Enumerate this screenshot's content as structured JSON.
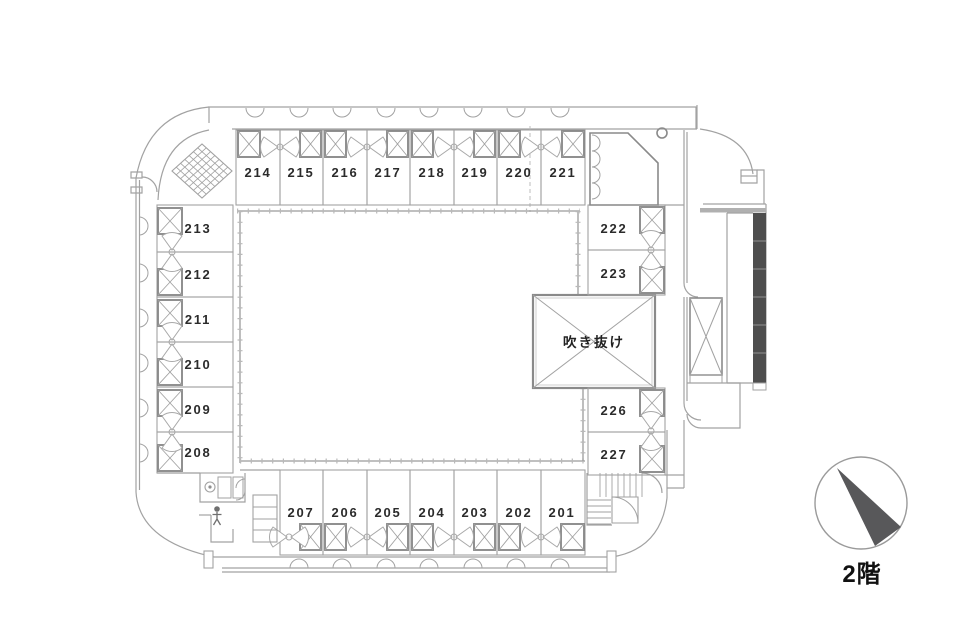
{
  "floor_label": "2階",
  "atrium": {
    "label": "吹き抜け",
    "x": 533,
    "y": 295,
    "w": 122,
    "h": 93
  },
  "colors": {
    "line": "#a2a2a2",
    "wall": "#8a8a8a",
    "text": "#2b2b2b",
    "hatch_dark": "#4e4e4e",
    "compass_arrow": "#58585a"
  },
  "rooms": [
    {
      "num": "214",
      "strip": "t",
      "x": 236,
      "y": 130,
      "w": 44,
      "h": 75,
      "bed": [
        238,
        131,
        22,
        26
      ],
      "lx": 258,
      "ly": 177
    },
    {
      "num": "215",
      "strip": "t",
      "x": 280,
      "y": 130,
      "w": 43,
      "h": 75,
      "bed": [
        300,
        131,
        21,
        26
      ],
      "lx": 301,
      "ly": 177
    },
    {
      "num": "216",
      "strip": "t",
      "x": 323,
      "y": 130,
      "w": 44,
      "h": 75,
      "bed": [
        325,
        131,
        21,
        26
      ],
      "lx": 345,
      "ly": 177
    },
    {
      "num": "217",
      "strip": "t",
      "x": 367,
      "y": 130,
      "w": 43,
      "h": 75,
      "bed": [
        387,
        131,
        21,
        26
      ],
      "lx": 388,
      "ly": 177
    },
    {
      "num": "218",
      "strip": "t",
      "x": 410,
      "y": 130,
      "w": 44,
      "h": 75,
      "bed": [
        412,
        131,
        21,
        26
      ],
      "lx": 432,
      "ly": 177
    },
    {
      "num": "219",
      "strip": "t",
      "x": 454,
      "y": 130,
      "w": 43,
      "h": 75,
      "bed": [
        474,
        131,
        21,
        26
      ],
      "lx": 475,
      "ly": 177
    },
    {
      "num": "220",
      "strip": "t",
      "x": 497,
      "y": 130,
      "w": 44,
      "h": 75,
      "bed": [
        499,
        131,
        21,
        26
      ],
      "lx": 519,
      "ly": 177
    },
    {
      "num": "221",
      "strip": "t",
      "x": 541,
      "y": 130,
      "w": 44,
      "h": 75,
      "bed": [
        562,
        131,
        22,
        26
      ],
      "lx": 563,
      "ly": 177
    },
    {
      "num": "213",
      "strip": "l",
      "x": 157,
      "y": 205,
      "w": 76,
      "h": 47,
      "bed": [
        158,
        208,
        24,
        26
      ],
      "lx": 198,
      "ly": 233
    },
    {
      "num": "212",
      "strip": "l",
      "x": 157,
      "y": 252,
      "w": 76,
      "h": 45,
      "bed": [
        158,
        269,
        24,
        26
      ],
      "lx": 198,
      "ly": 279
    },
    {
      "num": "211",
      "strip": "l",
      "x": 157,
      "y": 297,
      "w": 76,
      "h": 45,
      "bed": [
        158,
        300,
        24,
        26
      ],
      "lx": 198,
      "ly": 324
    },
    {
      "num": "210",
      "strip": "l",
      "x": 157,
      "y": 342,
      "w": 76,
      "h": 45,
      "bed": [
        158,
        359,
        24,
        26
      ],
      "lx": 198,
      "ly": 369
    },
    {
      "num": "209",
      "strip": "l",
      "x": 157,
      "y": 387,
      "w": 76,
      "h": 45,
      "bed": [
        158,
        390,
        24,
        26
      ],
      "lx": 198,
      "ly": 414
    },
    {
      "num": "208",
      "strip": "l",
      "x": 157,
      "y": 432,
      "w": 76,
      "h": 41,
      "bed": [
        158,
        445,
        24,
        26
      ],
      "lx": 198,
      "ly": 457
    },
    {
      "num": "207",
      "strip": "b",
      "x": 280,
      "y": 470,
      "w": 43,
      "h": 85,
      "bed": [
        300,
        524,
        21,
        26
      ],
      "lx": 301,
      "ly": 517
    },
    {
      "num": "206",
      "strip": "b",
      "x": 323,
      "y": 470,
      "w": 44,
      "h": 85,
      "bed": [
        325,
        524,
        21,
        26
      ],
      "lx": 345,
      "ly": 517
    },
    {
      "num": "205",
      "strip": "b",
      "x": 367,
      "y": 470,
      "w": 43,
      "h": 85,
      "bed": [
        387,
        524,
        21,
        26
      ],
      "lx": 388,
      "ly": 517
    },
    {
      "num": "204",
      "strip": "b",
      "x": 410,
      "y": 470,
      "w": 44,
      "h": 85,
      "bed": [
        412,
        524,
        21,
        26
      ],
      "lx": 432,
      "ly": 517
    },
    {
      "num": "203",
      "strip": "b",
      "x": 454,
      "y": 470,
      "w": 43,
      "h": 85,
      "bed": [
        474,
        524,
        21,
        26
      ],
      "lx": 475,
      "ly": 517
    },
    {
      "num": "202",
      "strip": "b",
      "x": 497,
      "y": 470,
      "w": 44,
      "h": 85,
      "bed": [
        499,
        524,
        21,
        26
      ],
      "lx": 519,
      "ly": 517
    },
    {
      "num": "201",
      "strip": "b",
      "x": 541,
      "y": 470,
      "w": 44,
      "h": 85,
      "bed": [
        561,
        524,
        23,
        26
      ],
      "lx": 562,
      "ly": 517
    },
    {
      "num": "222",
      "strip": "r",
      "x": 588,
      "y": 205,
      "w": 77,
      "h": 45,
      "bed": [
        640,
        207,
        24,
        26
      ],
      "lx": 614,
      "ly": 233
    },
    {
      "num": "223",
      "strip": "r",
      "x": 588,
      "y": 250,
      "w": 77,
      "h": 45,
      "bed": [
        640,
        267,
        24,
        26
      ],
      "lx": 614,
      "ly": 278
    },
    {
      "num": "226",
      "strip": "r",
      "x": 588,
      "y": 388,
      "w": 77,
      "h": 44,
      "bed": [
        640,
        390,
        24,
        26
      ],
      "lx": 614,
      "ly": 415
    },
    {
      "num": "227",
      "strip": "r",
      "x": 588,
      "y": 432,
      "w": 77,
      "h": 43,
      "bed": [
        640,
        446,
        24,
        26
      ],
      "lx": 614,
      "ly": 459
    }
  ],
  "bath_clusters": [
    {
      "cx": 280,
      "cy": 147,
      "axis": "h"
    },
    {
      "cx": 367,
      "cy": 147,
      "axis": "h"
    },
    {
      "cx": 454,
      "cy": 147,
      "axis": "h"
    },
    {
      "cx": 541,
      "cy": 147,
      "axis": "h"
    },
    {
      "cx": 289,
      "cy": 537,
      "axis": "h"
    },
    {
      "cx": 367,
      "cy": 537,
      "axis": "h"
    },
    {
      "cx": 454,
      "cy": 537,
      "axis": "h"
    },
    {
      "cx": 541,
      "cy": 537,
      "axis": "h"
    },
    {
      "cx": 172,
      "cy": 252,
      "axis": "v"
    },
    {
      "cx": 172,
      "cy": 342,
      "axis": "v"
    },
    {
      "cx": 172,
      "cy": 432,
      "axis": "v"
    },
    {
      "cx": 651,
      "cy": 250,
      "axis": "v"
    },
    {
      "cx": 651,
      "cy": 431,
      "axis": "v"
    }
  ]
}
